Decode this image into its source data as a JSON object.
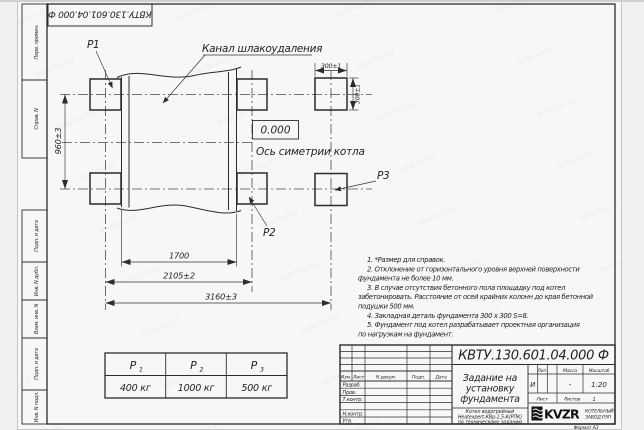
{
  "watermark": {
    "text": "kotel-kvr.kz"
  },
  "corner_stamp": {
    "doc_number": "КВТУ.130.601.04.000 Ф"
  },
  "margin_columns": {
    "perv_primen": "Перв. примен.",
    "sprav_n": "Справ. N",
    "podp_i_data_upper": "Подп. и дата",
    "inv_n_dubl": "Инв. N дубл.",
    "vzam_inv_n": "Взам. инв. N",
    "podp_i_data_lower": "Подп. и дата",
    "inv_n_podl": "Инв. N подл."
  },
  "drawing": {
    "channel_label": "Канал шлакоудаления",
    "p1_label": "P1",
    "p2_label": "P2",
    "p3_label": "P3",
    "elevation": "0.000",
    "axis_label": "Ось симетрии котла",
    "dim_300_top": "300±1",
    "dim_300_right": "300±1",
    "dim_960": "960±3",
    "dim_1700": "1700",
    "dim_2105": "2105±2",
    "dim_3160": "3160±3"
  },
  "loads_table": {
    "columns": [
      {
        "symbol": "P",
        "sub": "1",
        "value": "400 кг"
      },
      {
        "symbol": "P",
        "sub": "2",
        "value": "1000 кг"
      },
      {
        "symbol": "P",
        "sub": "3",
        "value": "500 кг"
      }
    ]
  },
  "notes": {
    "lines": [
      "1. *Размер для справок.",
      "2. Отклонение от горизонтального уровня верхней поверхности",
      "фундамента не более 10 мм.",
      "3. В случае отсутствия бетонного пола площадку под котел",
      "забетонировать. Расстояние от осей крайних колонн до края бетонной",
      "подушки 500 мм.",
      "4. Закладная деталь фундамента  300 х 300  S=8.",
      "5. Фундамент под котел разрабатывает проектная организация",
      "по нагрузкам на фундамент."
    ]
  },
  "title_block": {
    "doc_number": "КВТУ.130.601.04.000 Ф",
    "title_lines": [
      "Задание на",
      "установку",
      "фундамента"
    ],
    "subtitle_lines": [
      "Котел водогрейный",
      "Heatexpert-КВр-1,5-К(РПК)",
      "по техническому заданию"
    ],
    "header_cols": {
      "izm": "Изм.",
      "list": "Лист",
      "n_dokum": "N докум.",
      "podp": "Подп.",
      "data": "Дата"
    },
    "row_labels": {
      "razrab": "Разраб.",
      "prov": "Пров.",
      "t_kontr": "Т.контр.",
      "n_kontr": "Н.контр.",
      "utv": "Утв."
    },
    "lit_header": "Лит.",
    "massa_header": "Масса",
    "masshtab_header": "Масштаб",
    "lit_value": "И",
    "massa_value": "-",
    "masshtab_value": "1:20",
    "list_label": "Лист",
    "listov_label": "Листов",
    "listov_value": "1",
    "logo_text": "KVZR",
    "logo_caption_1": "КОТЕЛЬНЫЙ",
    "logo_caption_2": "ЗАВОД РЭП",
    "format_label": "Формат А3"
  },
  "colors": {
    "paper": "#f6f6f4",
    "line": "#2c2c2c",
    "centerline": "#4a4a4a"
  }
}
